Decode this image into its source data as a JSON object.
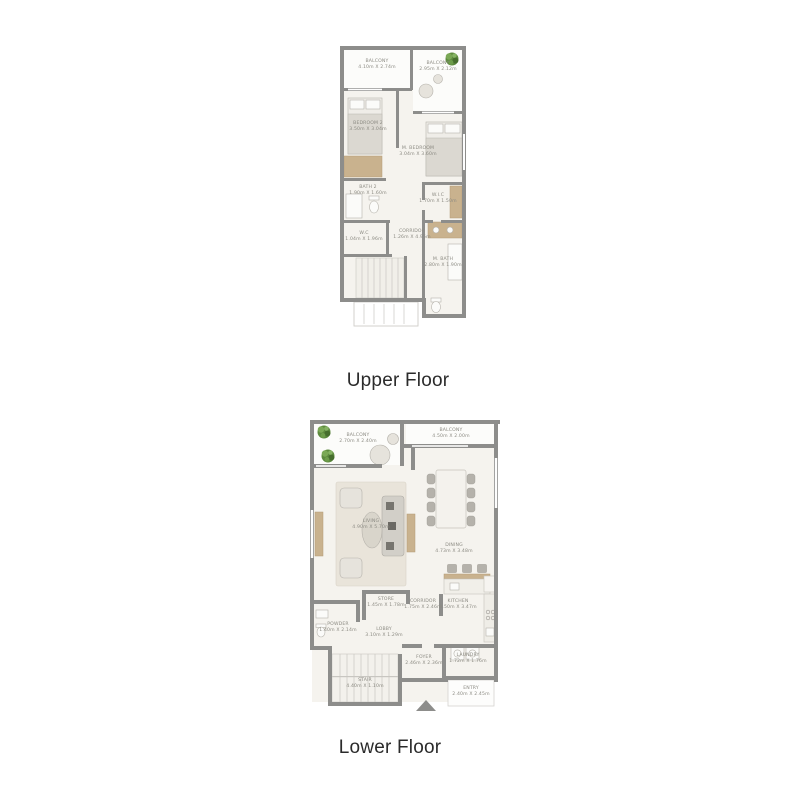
{
  "titles": {
    "upper": "Upper Floor",
    "lower": "Lower Floor"
  },
  "colors": {
    "wall": "#8d8d8b",
    "interior_floor": "#f5f3ee",
    "balcony_floor": "#fcfcfa",
    "wood_accent": "#c9b28e",
    "label_text": "#8b8a82",
    "title_text": "#2b2b2b",
    "plant_green": "#5d8a3e",
    "plant_green_light": "#7aa855"
  },
  "floors": {
    "upper": {
      "title": "Upper Floor",
      "rooms": {
        "balcony_left": {
          "name": "BALCONY",
          "dims": "4.10m X 2.74m"
        },
        "balcony_right": {
          "name": "BALCONY",
          "dims": "2.95m X 2.12m"
        },
        "bedroom2": {
          "name": "BEDROOM 2",
          "dims": "3.50m X 3.04m"
        },
        "master_bedroom": {
          "name": "M. BEDROOM",
          "dims": "3.04m X 3.60m"
        },
        "bath2": {
          "name": "BATH 2",
          "dims": "1.90m X 1.60m"
        },
        "wic": {
          "name": "W.I.C",
          "dims": "1.70m X 1.50m"
        },
        "wc": {
          "name": "W.C",
          "dims": "1.04m X 1.96m"
        },
        "corridor": {
          "name": "CORRIDOR",
          "dims": "1.26m X 4.95m"
        },
        "master_bath": {
          "name": "M. BATH",
          "dims": "2.80m X 1.90m"
        }
      }
    },
    "lower": {
      "title": "Lower Floor",
      "rooms": {
        "balcony_left": {
          "name": "BALCONY",
          "dims": "2.70m X 2.40m"
        },
        "balcony_right": {
          "name": "BALCONY",
          "dims": "4.50m X 2.00m"
        },
        "living": {
          "name": "LIVING",
          "dims": "4.90m X 5.70m"
        },
        "dining": {
          "name": "DINING",
          "dims": "4.73m X 3.48m"
        },
        "store": {
          "name": "STORE",
          "dims": "1.45m X 1.78m"
        },
        "corridor": {
          "name": "CORRIDOR",
          "dims": "1.75m X 2.46m"
        },
        "kitchen": {
          "name": "KITCHEN",
          "dims": "3.50m X 3.47m"
        },
        "powder": {
          "name": "POWDER",
          "dims": "1.40m X 2.14m"
        },
        "lobby": {
          "name": "LOBBY",
          "dims": "3.10m X 1.29m"
        },
        "foyer": {
          "name": "FOYER",
          "dims": "2.46m X 2.36m"
        },
        "laundry": {
          "name": "LAUNDRY",
          "dims": "1.72m X 1.76m"
        },
        "stair": {
          "name": "STAIR",
          "dims": "4.40m X 1.10m"
        },
        "entry": {
          "name": "ENTRY",
          "dims": "2.40m X 2.45m"
        }
      }
    }
  }
}
